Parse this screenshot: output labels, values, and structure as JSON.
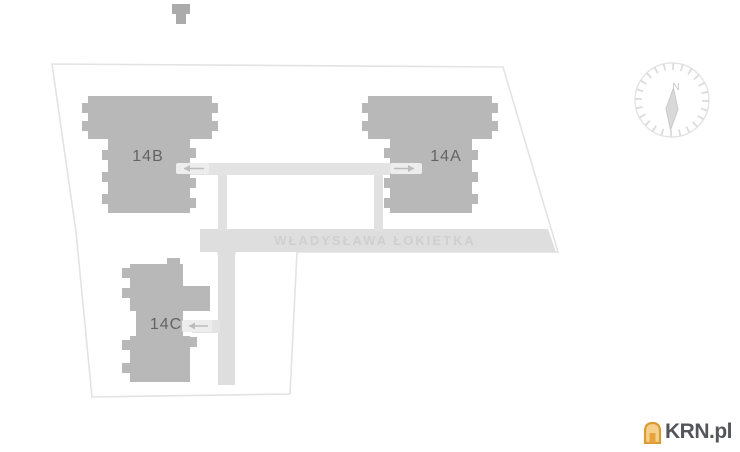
{
  "site_plan": {
    "buildings": [
      {
        "label": "14B"
      },
      {
        "label": "14A"
      },
      {
        "label": "14C"
      }
    ],
    "street_name": "WŁADYSŁAWA ŁOKIETKA",
    "compass": {
      "north_label": "N"
    },
    "arrows": [
      {
        "icon": "arrow-left-icon",
        "target": "14B"
      },
      {
        "icon": "arrow-right-icon",
        "target": "14A"
      },
      {
        "icon": "arrow-left-icon",
        "target": "14C"
      }
    ]
  },
  "branding": {
    "logo_text": "KRN.pl",
    "logo_icon": "house-icon"
  },
  "colors": {
    "background": "#ffffff",
    "building": "#b8b8b8",
    "neighbor_building": "#ababab",
    "road": "#dedede",
    "path": "#e3e3e3",
    "arrow_pill": "#ededed",
    "arrow": "#bcbcbc",
    "boundary": "#e3e3e3",
    "building_label": "#636363",
    "street_label": "#cfcfcf",
    "compass": "#dcdcdc",
    "compass_needle": "#d9d9d9",
    "logo_text": "#54555a",
    "logo_orange": "#e8a33c",
    "logo_orange_light": "#f5d08c"
  }
}
